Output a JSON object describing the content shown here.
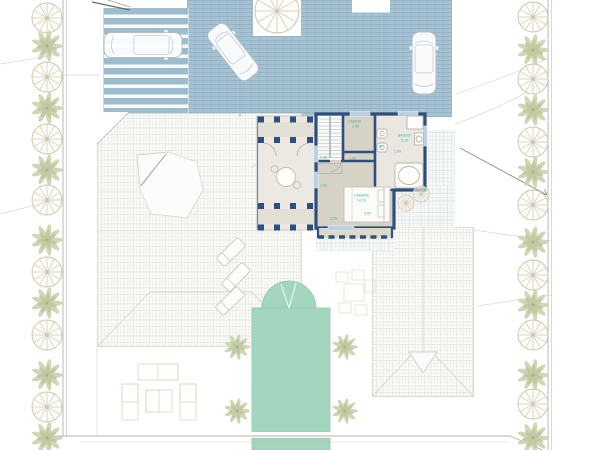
{
  "document": {
    "type": "architectural-site-plan",
    "description": "Villa upper floor plan over site plan with driveway, carport, pool, neighbor roofs and perimeter trees"
  },
  "colors": {
    "paving_blue": "#a7c3d3",
    "paving_line": "#7c9fb5",
    "wall_blue": "#2e4f7e",
    "window_blue": "#bccfe2",
    "room_floor": "#d7d2c6",
    "bath_floor": "#eae7e1",
    "terrace_floor": "#ebe9e1",
    "pool_teal": "#a4d5bf",
    "annotation_teal": "#2fb3ad",
    "roof_hatch": "#e9e9e4",
    "tree_green": "#cbd3ae",
    "tree_outline": "#ccc5aa",
    "boundary_gray": "#b3b3ae",
    "car_outline": "#b4bac3"
  },
  "annotations": [
    {
      "text": "CABINA",
      "x": 348,
      "y": 120
    },
    {
      "text": "2.40",
      "x": 352,
      "y": 125
    },
    {
      "text": "BAGNO",
      "x": 398,
      "y": 134
    },
    {
      "text": "5.10",
      "x": 401,
      "y": 139
    },
    {
      "text": "CAMERA",
      "x": 354,
      "y": 194
    },
    {
      "text": "14.20",
      "x": 357,
      "y": 199
    },
    {
      "text": "4.05",
      "x": 364,
      "y": 212
    },
    {
      "text": "2.35",
      "x": 320,
      "y": 156
    },
    {
      "text": "1.20",
      "x": 349,
      "y": 157
    },
    {
      "text": "1.50",
      "x": 320,
      "y": 184
    },
    {
      "text": "2.60",
      "x": 394,
      "y": 150
    },
    {
      "text": "90",
      "x": 379,
      "y": 145
    },
    {
      "text": "3.55",
      "x": 330,
      "y": 217
    }
  ],
  "site": {
    "trees_left": {
      "x": 47,
      "items": [
        {
          "t": "w",
          "y": 18
        },
        {
          "t": "p",
          "y": 46
        },
        {
          "t": "w",
          "y": 77
        },
        {
          "t": "p",
          "y": 108
        },
        {
          "t": "w",
          "y": 139
        },
        {
          "t": "p",
          "y": 170
        },
        {
          "t": "w",
          "y": 200
        },
        {
          "t": "p",
          "y": 240
        },
        {
          "t": "w",
          "y": 272
        },
        {
          "t": "p",
          "y": 303
        },
        {
          "t": "w",
          "y": 335
        },
        {
          "t": "p",
          "y": 375
        },
        {
          "t": "w",
          "y": 407
        },
        {
          "t": "p",
          "y": 438
        }
      ]
    },
    "trees_right": {
      "x": 533,
      "items": [
        {
          "t": "w",
          "y": 17
        },
        {
          "t": "p",
          "y": 50
        },
        {
          "t": "w",
          "y": 79
        },
        {
          "t": "p",
          "y": 110
        },
        {
          "t": "w",
          "y": 142
        },
        {
          "t": "p",
          "y": 172
        },
        {
          "t": "w",
          "y": 205
        },
        {
          "t": "p",
          "y": 242
        },
        {
          "t": "w",
          "y": 275
        },
        {
          "t": "p",
          "y": 305
        },
        {
          "t": "w",
          "y": 335
        },
        {
          "t": "p",
          "y": 375
        },
        {
          "t": "w",
          "y": 404
        },
        {
          "t": "p",
          "y": 438
        }
      ]
    },
    "top_tree": {
      "x": 277,
      "y": 11,
      "r": 22
    },
    "garden_palms": [
      {
        "x": 237,
        "y": 347
      },
      {
        "x": 345,
        "y": 347
      },
      {
        "x": 237,
        "y": 411
      },
      {
        "x": 345,
        "y": 411
      }
    ],
    "bushes": [
      {
        "x": 406,
        "y": 203,
        "r": 8
      },
      {
        "x": 421,
        "y": 194,
        "r": 8
      }
    ],
    "cars": [
      {
        "name": "carport-car",
        "x": 143,
        "y": 45,
        "angle": 90,
        "length": 78,
        "width": 25
      },
      {
        "name": "driveway-car-angled",
        "x": 233,
        "y": 52,
        "angle": -38,
        "length": 62,
        "width": 23
      },
      {
        "name": "driveway-car-parked",
        "x": 424,
        "y": 63,
        "angle": 0,
        "length": 62,
        "width": 24
      }
    ],
    "loungers": [
      {
        "x": 231,
        "y": 252,
        "angle": -44
      },
      {
        "x": 236,
        "y": 277,
        "angle": -46
      },
      {
        "x": 230,
        "y": 301,
        "angle": -44
      }
    ],
    "pool": {
      "x": 252,
      "y": 308,
      "w": 78,
      "h": 124,
      "dome_cx": 289,
      "dome_r": 27,
      "walk_y": 432,
      "walk_h": 6,
      "tail_y": 438,
      "tail_h": 12
    },
    "furniture_left": [
      [
        138,
        364,
        40,
        16
      ],
      [
        158,
        364,
        20,
        16
      ],
      [
        122,
        384,
        16,
        36
      ],
      [
        122,
        384,
        16,
        18
      ],
      [
        180,
        384,
        16,
        36
      ],
      [
        180,
        384,
        16,
        18
      ],
      [
        146,
        390,
        26,
        22
      ],
      [
        146,
        390,
        13,
        22
      ]
    ],
    "furniture_right": [
      [
        344,
        284,
        20,
        17
      ],
      [
        336,
        272,
        12,
        10
      ],
      [
        352,
        270,
        12,
        10
      ],
      [
        365,
        280,
        10,
        12
      ],
      [
        339,
        303,
        12,
        10
      ],
      [
        355,
        305,
        12,
        10
      ]
    ]
  }
}
